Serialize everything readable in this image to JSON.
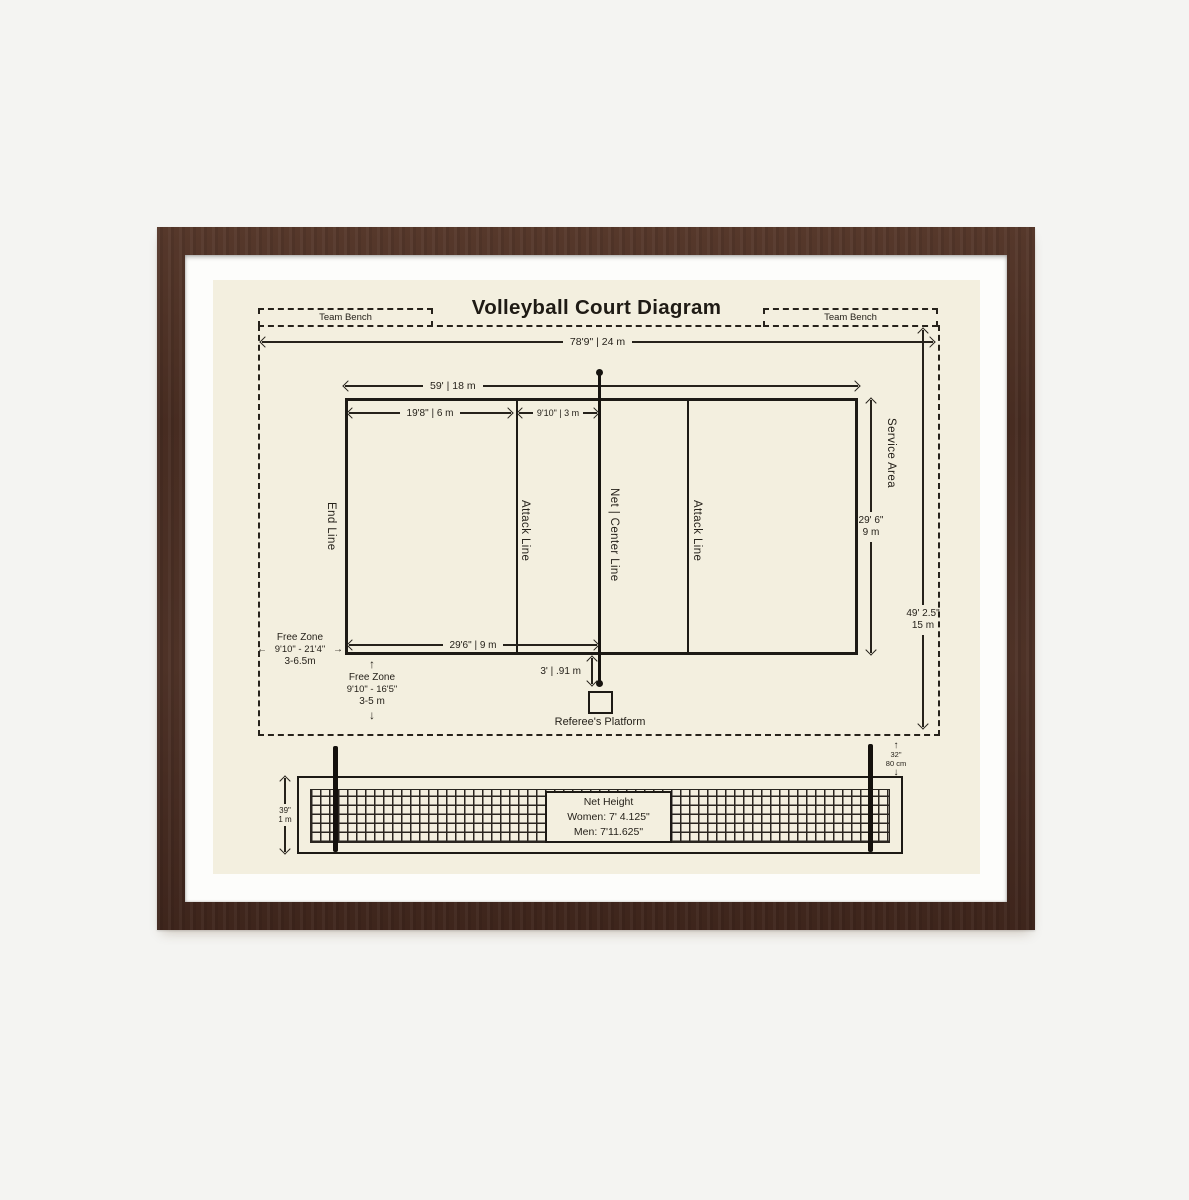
{
  "title": "Volleyball Court Diagram",
  "benches": {
    "left": "Team Bench",
    "right": "Team Bench"
  },
  "dimensions": {
    "overall_length": "78'9\" | 24 m",
    "court_length": "59' | 18 m",
    "attack_zone": "19'8\" | 6 m",
    "front_zone": "9'10\" | 3 m",
    "half_court": "29'6\" | 9 m",
    "court_width_ft": "29' 6\"",
    "court_width_m": "9 m",
    "total_width_ft": "49' 2.5\"",
    "total_width_m": "15 m",
    "platform_offset": "3' | .91 m"
  },
  "court_labels": {
    "end_line": "End Line",
    "attack_line_left": "Attack Line",
    "net_center_line": "Net | Center Line",
    "attack_line_right": "Attack Line",
    "service_area": "Service Area"
  },
  "free_zone_side": {
    "title": "Free Zone",
    "range": "9'10\" - 21'4\"",
    "metric": "3-6.5m"
  },
  "free_zone_end": {
    "title": "Free Zone",
    "range": "9'10\" - 16'5\"",
    "metric": "3-5 m"
  },
  "referee": {
    "label": "Referee's Platform"
  },
  "net": {
    "height_title": "Net Height",
    "women": "Women: 7' 4.125\"",
    "men": "Men: 7'11.625\"",
    "post_height_in": "39\"",
    "post_height_m": "1 m",
    "band_width_in": "32\"",
    "band_width_cm": "80 cm"
  },
  "icons": {
    "arrow_up": "↑",
    "arrow_down": "↓",
    "arrow_left": "←",
    "arrow_right": "→"
  },
  "colors": {
    "paper": "#f3efdf",
    "ink": "#26221b",
    "frame_wood": "#4a2e24",
    "mat": "#fdfdfb",
    "page_bg": "#f4f4f2"
  }
}
